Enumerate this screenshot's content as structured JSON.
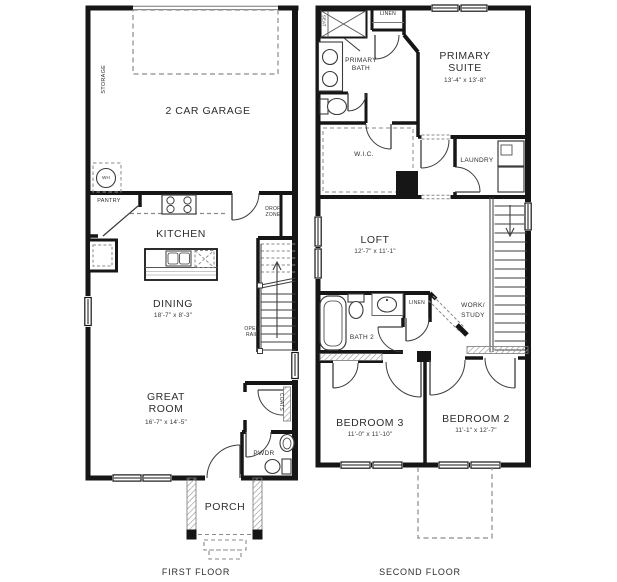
{
  "colors": {
    "wall": "#161616",
    "thin_line": "#3c3c3c",
    "dashed_line": "#8a8a8a",
    "label_text": "#2e2e2e",
    "background": "#ffffff"
  },
  "first_floor": {
    "caption": "FIRST FLOOR",
    "garage": "2 CAR GARAGE",
    "storage": "STORAGE",
    "water_heater": "WH",
    "pantry": "PANTRY",
    "kitchen": "KITCHEN",
    "drop_zone": "DROP ZONE",
    "dining": "DINING",
    "dining_dims": "18'-7\" x 8'-3\"",
    "open_rail": "OPEN RAIL",
    "great_room": "GREAT ROOM",
    "great_room_dims": "16'-7\" x 14'-5\"",
    "coats": "COATS",
    "powder": "PWDR",
    "porch": "PORCH"
  },
  "second_floor": {
    "caption": "SECOND FLOOR",
    "seat": "SEAT",
    "linen_upper": "LINEN",
    "primary_bath": "PRIMARY BATH",
    "primary_suite": "PRIMARY SUITE",
    "primary_suite_dims": "13'-4\" x 13'-8\"",
    "wic": "W.I.C.",
    "laundry": "LAUNDRY",
    "loft": "LOFT",
    "loft_dims": "12'-7\" x 11'-1\"",
    "work_study_line1": "WORK/",
    "work_study_line2": "STUDY",
    "bath2": "BATH 2",
    "linen_hall": "LINEN",
    "bedroom3": "BEDROOM 3",
    "bedroom3_dims": "11'-0\" x 11'-10\"",
    "bedroom2": "BEDROOM 2",
    "bedroom2_dims": "11'-1\" x 12'-7\""
  }
}
